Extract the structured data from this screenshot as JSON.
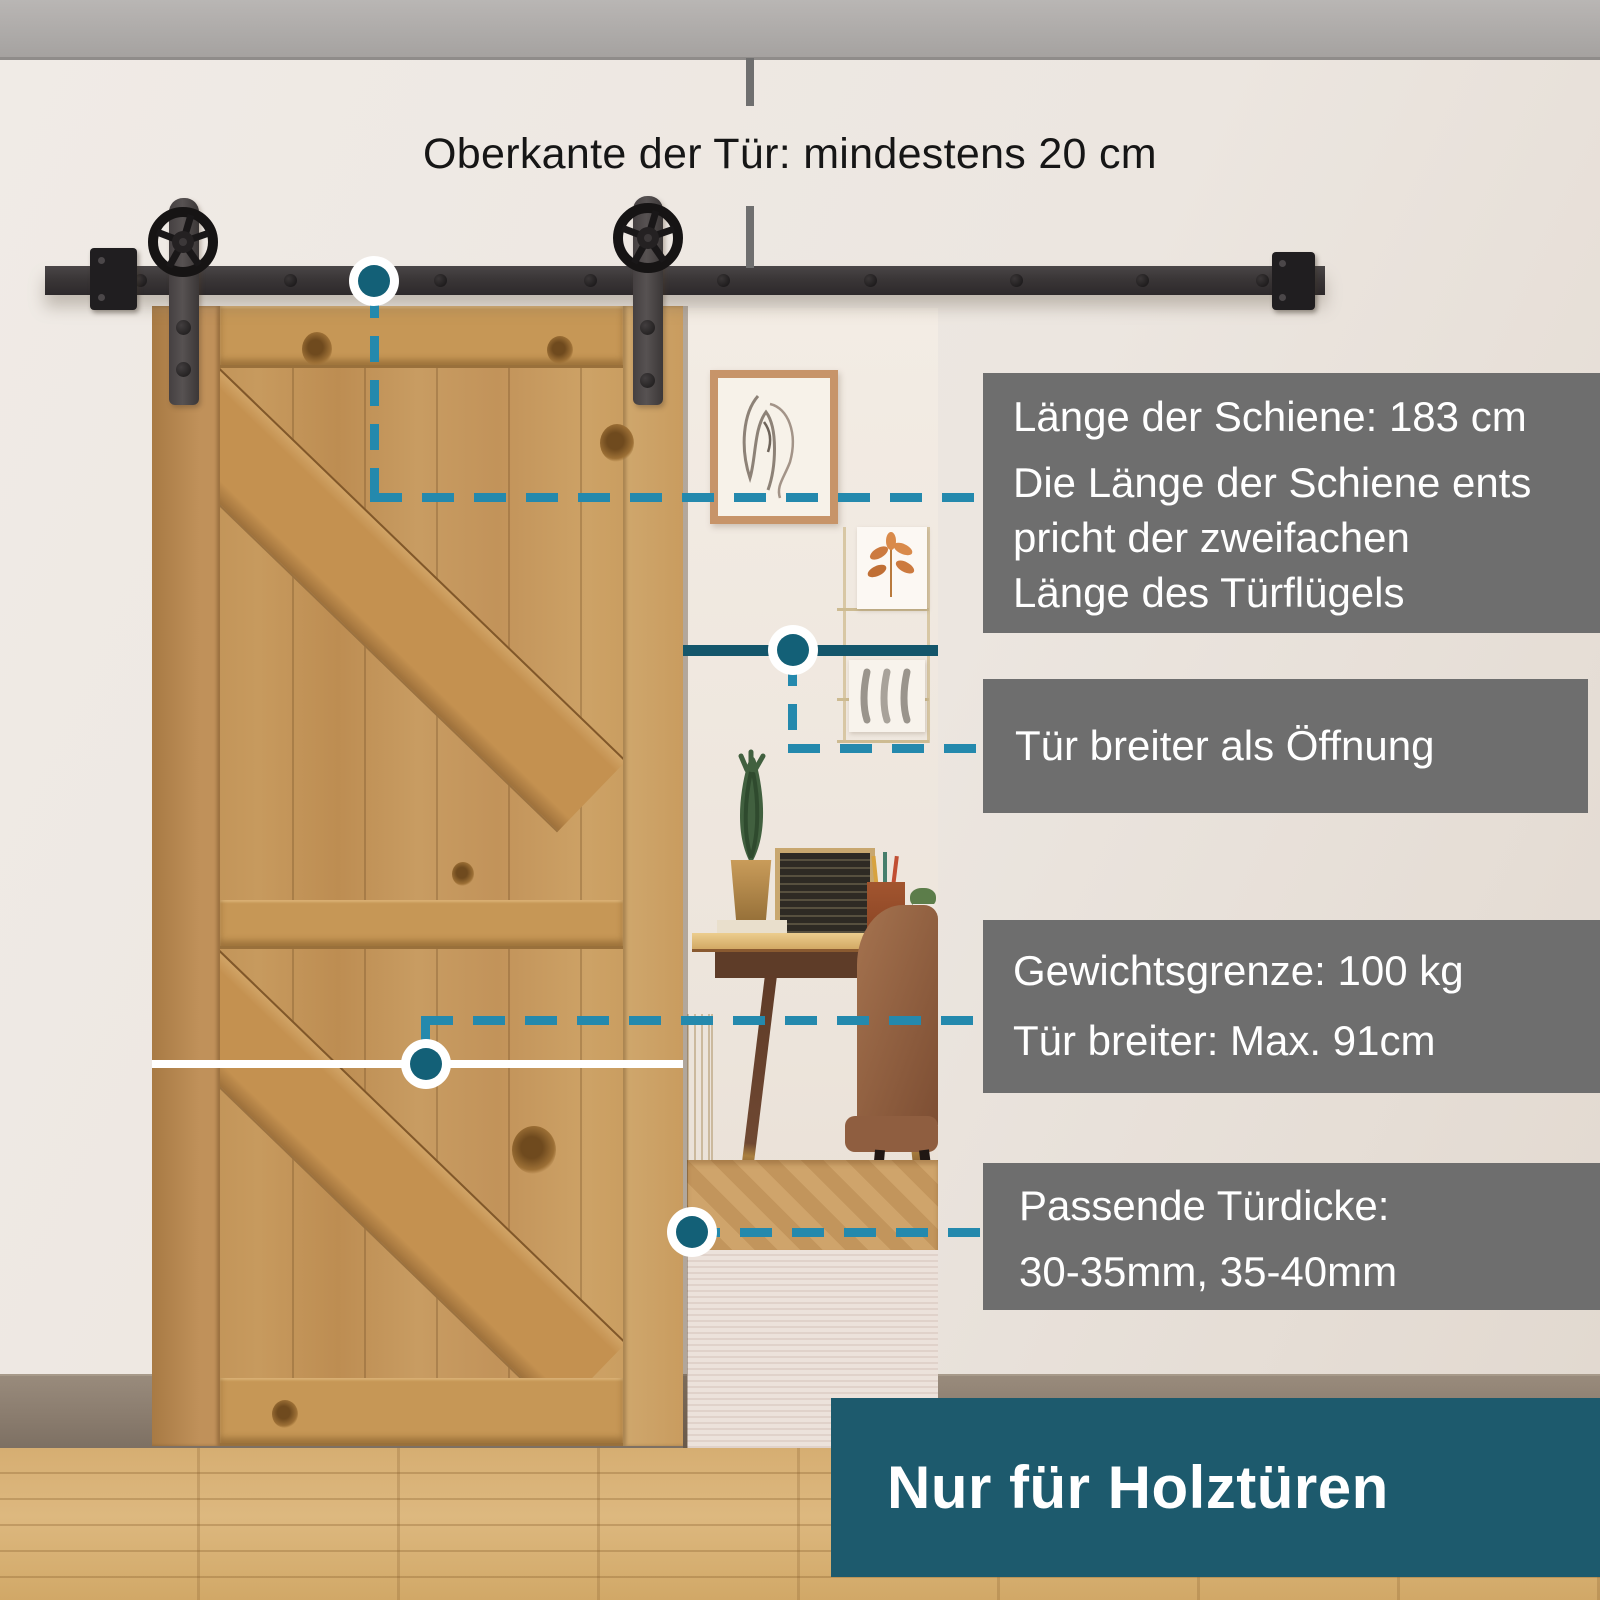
{
  "annotations": {
    "top_label": "Oberkante der Tür: mindestens 20 cm"
  },
  "callouts": [
    {
      "title": "Länge der Schiene: 183 cm",
      "body_lines": [
        "Die Länge der Schiene ents",
        "pricht der zweifachen",
        "Länge des Türflügels"
      ]
    },
    {
      "lines": [
        "Tür breiter als Öffnung"
      ]
    },
    {
      "lines": [
        "Gewichtsgrenze: 100 kg",
        "Tür breiter: Max. 91cm"
      ]
    },
    {
      "lines": [
        "Passende Türdicke:",
        "30-35mm, 35-40mm"
      ]
    }
  ],
  "footer_badge": {
    "label": "Nur für Holztüren"
  },
  "colors": {
    "accent_dash": "#2489ad",
    "accent_node": "#136077",
    "opening_line": "#14566b",
    "callout_gray": "#6e6e6e",
    "badge_teal": "#1d5a6d",
    "rail_metal": "#3a3637",
    "door_wood": "#c2935a",
    "floor_wood": "#d6ae72",
    "wall": "#ece6e0"
  }
}
